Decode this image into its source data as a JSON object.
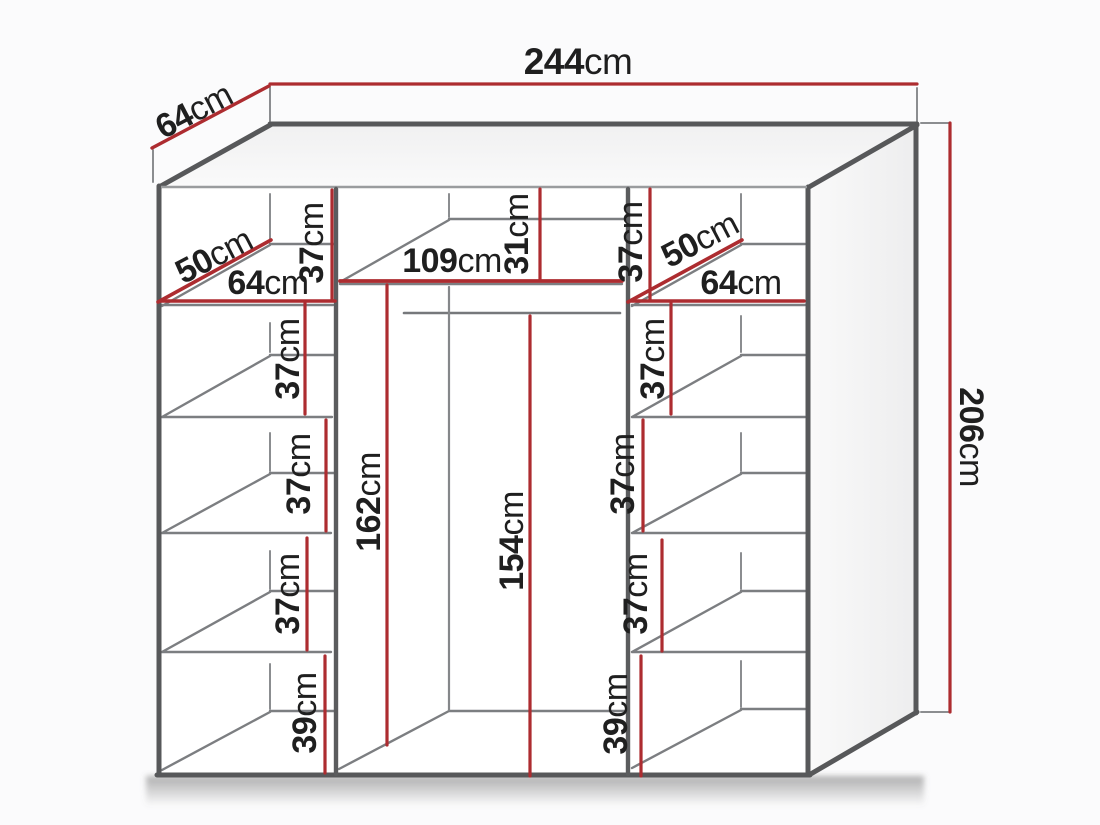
{
  "diagram": {
    "kind": "wardrobe-dimension-diagram",
    "unit": "cm",
    "overall": {
      "width": {
        "num": "244",
        "unit": "cm"
      },
      "depth": {
        "num": "64",
        "unit": "cm"
      },
      "height": {
        "num": "206",
        "unit": "cm"
      }
    },
    "left_column": {
      "shelf_depth": {
        "num": "50",
        "unit": "cm"
      },
      "shelf_width": {
        "num": "64",
        "unit": "cm"
      },
      "sections": [
        {
          "num": "37",
          "unit": "cm"
        },
        {
          "num": "37",
          "unit": "cm"
        },
        {
          "num": "37",
          "unit": "cm"
        },
        {
          "num": "37",
          "unit": "cm"
        },
        {
          "num": "39",
          "unit": "cm"
        }
      ]
    },
    "middle_column": {
      "width": {
        "num": "109",
        "unit": "cm"
      },
      "top_section_height": {
        "num": "31",
        "unit": "cm"
      },
      "hanging_space_height": {
        "num": "162",
        "unit": "cm"
      },
      "rail_to_floor_height": {
        "num": "154",
        "unit": "cm"
      }
    },
    "right_column": {
      "shelf_depth": {
        "num": "50",
        "unit": "cm"
      },
      "shelf_width": {
        "num": "64",
        "unit": "cm"
      },
      "sections": [
        {
          "num": "37",
          "unit": "cm"
        },
        {
          "num": "37",
          "unit": "cm"
        },
        {
          "num": "37",
          "unit": "cm"
        },
        {
          "num": "37",
          "unit": "cm"
        },
        {
          "num": "39",
          "unit": "cm"
        }
      ]
    },
    "colors": {
      "dimension_red": "#ad2c30",
      "outline_gray": "#57585a",
      "detail_gray": "#7c7e81",
      "text_black": "#1f1f1f",
      "background": "#fbfbfc"
    }
  }
}
